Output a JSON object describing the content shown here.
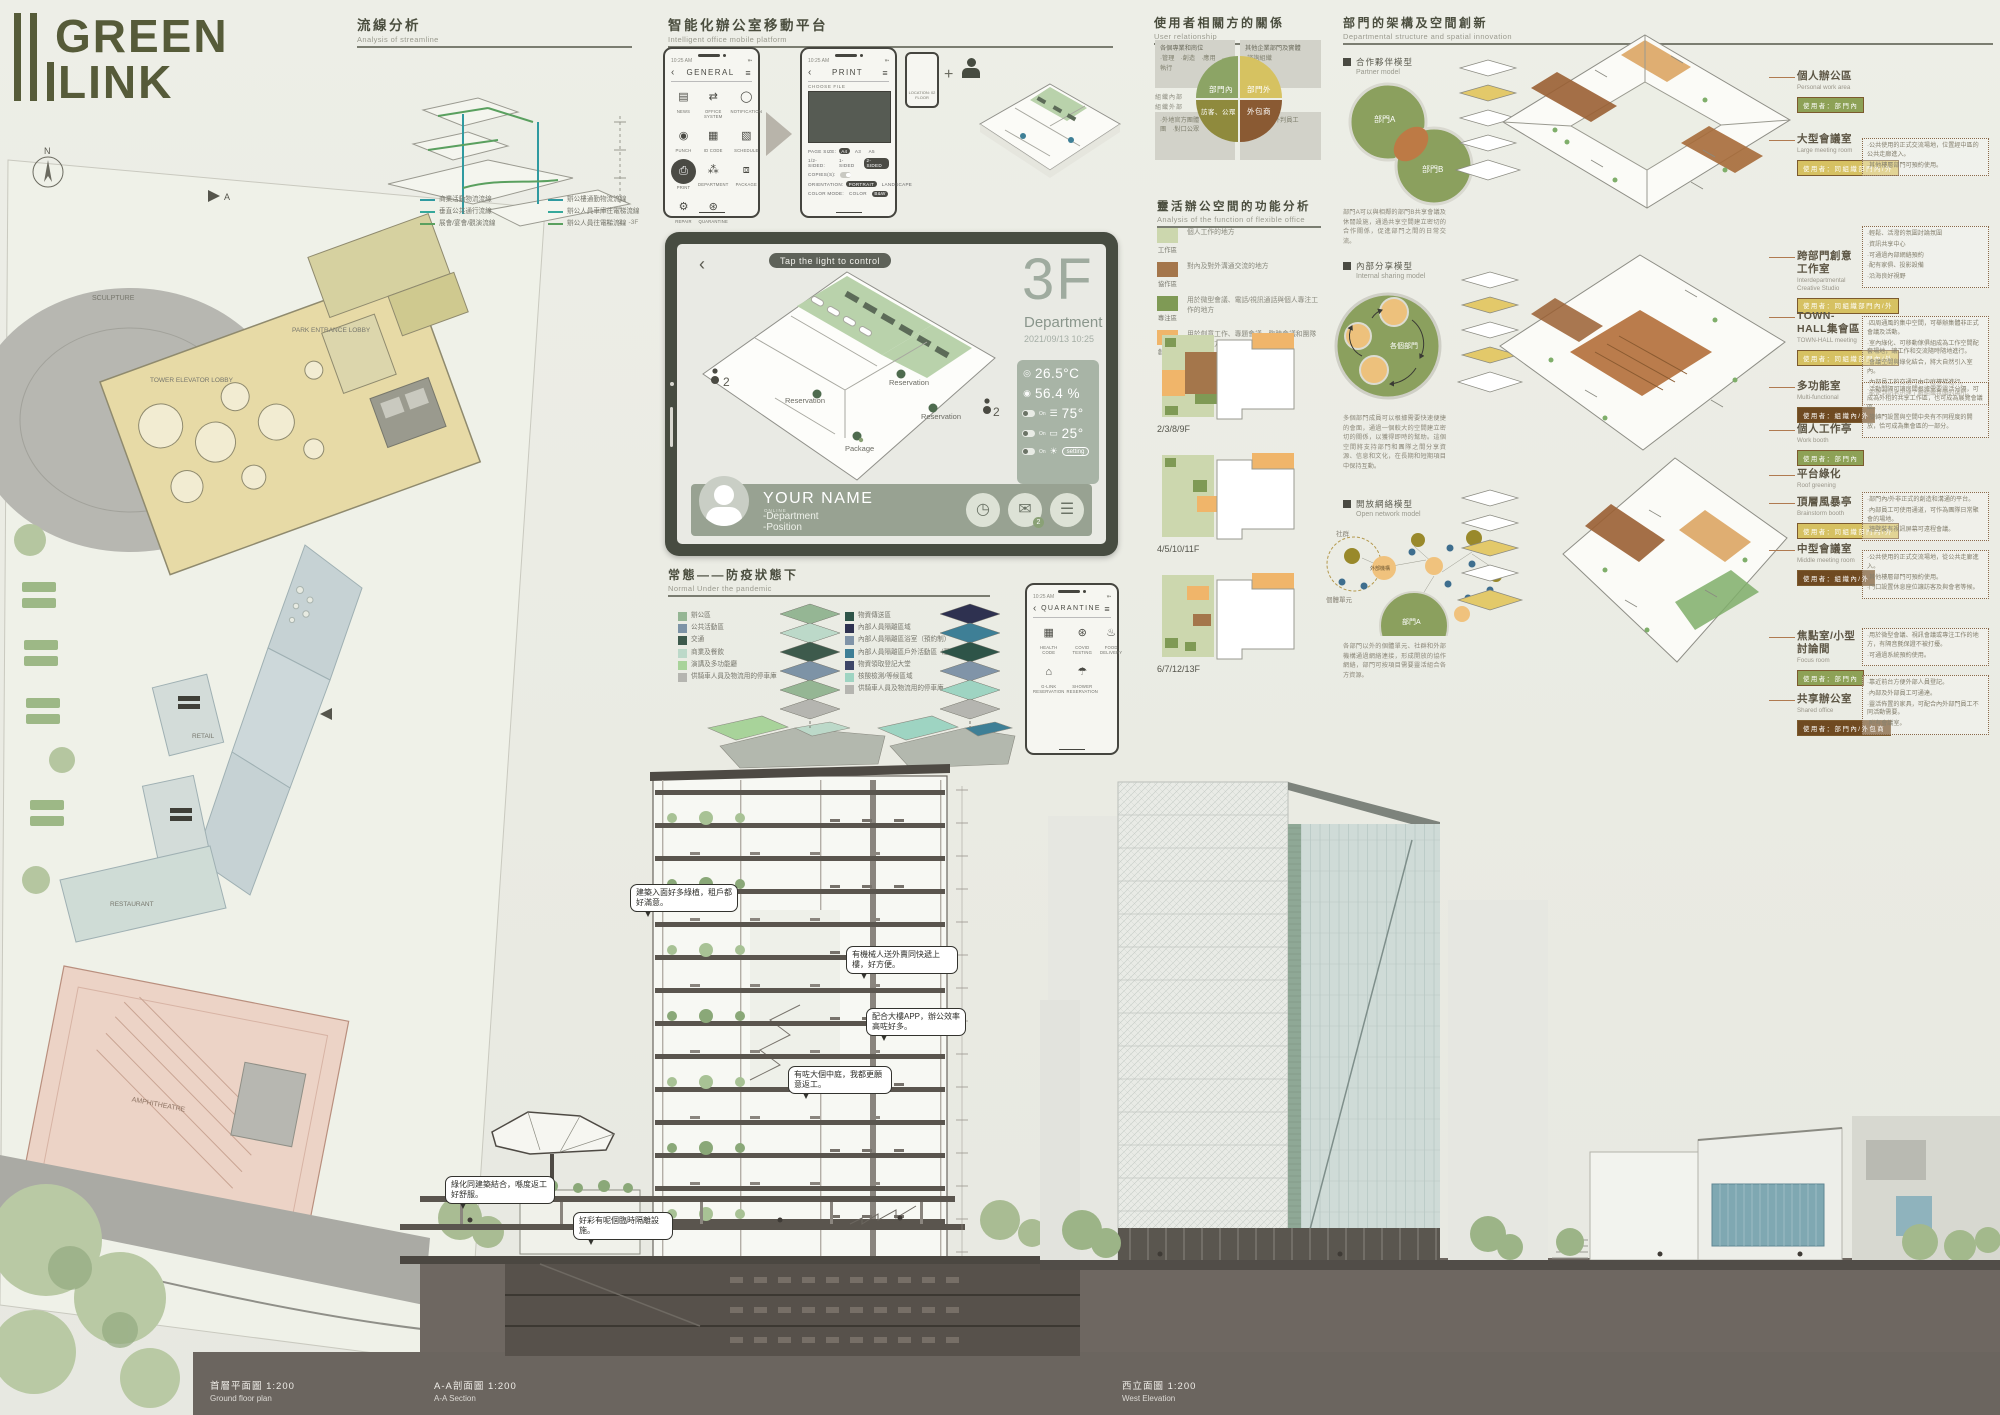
{
  "logo": {
    "line1": "GREEN",
    "line2": "LINK"
  },
  "compass": "N",
  "site_labels": [
    "SCULPTURE",
    "PARK ENTRANCE LOBBY",
    "TOWER ELEVATOR LOBBY",
    "RETAIL",
    "RETAIL",
    "RESTAURANT",
    "AMPHITHEATRE"
  ],
  "streamline": {
    "title_zh": "流線分析",
    "title_en": "Analysis of streamline",
    "levels_note": "-1、-2、-3F",
    "legend_a": [
      {
        "color": "#2f9aa0",
        "label": "商業活動物流流線"
      },
      {
        "color": "#35a89b",
        "label": "垂直公共通行流線"
      },
      {
        "color": "#5aa05f",
        "label": "展會/宴會/觀演流線"
      }
    ],
    "legend_b": [
      {
        "color": "#2f9aa0",
        "label": "辦公樓通勤物流流線"
      },
      {
        "color": "#35a89b",
        "label": "辦公人員車庫往電梯流線"
      },
      {
        "color": "#5aa05f",
        "label": "辦公人員往電梯流線"
      }
    ]
  },
  "platform": {
    "title_zh": "智能化辦公室移動平台",
    "title_en": "Intelligent office mobile platform",
    "general": {
      "time": "10:25 AM",
      "back": "‹",
      "title": "GENERAL",
      "menu": "≡",
      "apps": [
        {
          "icon": "▤",
          "label": "NEWS"
        },
        {
          "icon": "⇄",
          "label": "OFFICE SYSTEM"
        },
        {
          "icon": "◯",
          "label": "NOTIFICATION"
        },
        {
          "icon": "◉",
          "label": "PUNCH"
        },
        {
          "icon": "▦",
          "label": "ID CODE"
        },
        {
          "icon": "▧",
          "label": "SCHEDULE"
        },
        {
          "icon": "⎙",
          "label": "PRINT",
          "active": true
        },
        {
          "icon": "⁂",
          "label": "DEPARTMENT"
        },
        {
          "icon": "⧈",
          "label": "PACKAGE"
        },
        {
          "icon": "⚙",
          "label": "REPAIR"
        },
        {
          "icon": "⊛",
          "label": "QUARANTINE"
        }
      ]
    },
    "print": {
      "time": "10:25 AM",
      "back": "‹",
      "title": "PRINT",
      "menu": "≡",
      "choose_label": "CHOOSE FILE",
      "rows": [
        {
          "label": "PAGE SIZE:",
          "o1": "A4",
          "o2": "A3",
          "o3": "A5"
        },
        {
          "label": "1/2-SIDED:",
          "o1": "1-SIDED",
          "o2": "2-SIDED"
        },
        {
          "label": "COPIES(S):"
        },
        {
          "label": "ORIENTATION:",
          "o1": "PORTRAIT",
          "o2": "LANDSCAPE"
        },
        {
          "label": "COLOR MODE:",
          "o1": "COLOR",
          "o2": "B&W"
        }
      ]
    },
    "mini_phone": {
      "plus": "+",
      "location": "LOCATION:  02 FLOOR"
    }
  },
  "tablet": {
    "back": "‹",
    "pill": "Tap the light to control",
    "floor": "3F",
    "dept": "Department",
    "datetime": "2021/09/13 10:25",
    "temp": "26.5°C",
    "humidity": "56.4 %",
    "blinds": "75°",
    "heater": "25°",
    "toggle_label": "On",
    "setting_label": "setting",
    "plan_labels": [
      "Reservation",
      "Reservation",
      "Reservation",
      "Package"
    ],
    "occupancy": "2",
    "user": {
      "name": "YOUR NAME",
      "status": "ONLINE",
      "line1": "-Department",
      "line2": "-Position"
    }
  },
  "pandemic": {
    "title_zh": "常態——防疫狀態下",
    "title_en": "Normal Under the pandemic",
    "legend_normal": [
      {
        "c": "#95b694",
        "t": "辦公區"
      },
      {
        "c": "#7d93a6",
        "t": "公共活動區"
      },
      {
        "c": "#3d5a4c",
        "t": "交通"
      },
      {
        "c": "#bcd9c9",
        "t": "商業及餐飲"
      },
      {
        "c": "#a8d39a",
        "t": "演講及多功能廳"
      },
      {
        "c": "#b5b5b0",
        "t": "供騎車人員及物流用的停車庫"
      }
    ],
    "legend_pandemic": [
      {
        "c": "#2e5448",
        "t": "物資傳送區"
      },
      {
        "c": "#2e3150",
        "t": "內部人員隔離區域"
      },
      {
        "c": "#8094a8",
        "t": "內部人員隔離區浴室（預約制）"
      },
      {
        "c": "#3e7f96",
        "t": "內部人員隔離區戶外活動區（預約制）"
      },
      {
        "c": "#3d4668",
        "t": "物資領取登記大堂"
      },
      {
        "c": "#9ed4c2",
        "t": "核酸檢測/等候區域"
      },
      {
        "c": "#b5b5b0",
        "t": "供騎車人員及物流用的停車庫"
      }
    ]
  },
  "quarantine": {
    "time": "10:25 AM",
    "back": "‹",
    "title": "QUARANTINE",
    "menu": "≡",
    "apps": [
      {
        "icon": "▦",
        "label": "HEALTH CODE"
      },
      {
        "icon": "⊛",
        "label": "COVID TESTING"
      },
      {
        "icon": "♨",
        "label": "FOOD DELIVERY"
      },
      {
        "icon": "⌂",
        "label": "G-LINK RESERVATION"
      },
      {
        "icon": "☂",
        "label": "SHOWER RESERVATION"
      }
    ]
  },
  "user_relation": {
    "title_zh": "使用者相關方的關係",
    "title_en": "User relationship",
    "inner_label": "組織內部",
    "outer_label": "組織外部",
    "quadrants": [
      {
        "t": "部門內",
        "c": "#8ca465"
      },
      {
        "t": "部門外",
        "c": "#d6c261"
      },
      {
        "t": "訪客、公眾",
        "c": "#8f8a3d"
      },
      {
        "t": "外包商",
        "c": "#8a5a33"
      }
    ],
    "box_tl_head": "各個專業和崗位",
    "box_tl_lines": "·管理　·創造　·應用　·執行",
    "box_tr_head": "其他企業部門及實體",
    "box_tr_lines": "·諮詢組織",
    "box_bl_lines": "·外地官方團體　·民間社團　·對口公眾",
    "box_br_lines": "·供應商　·外判員工"
  },
  "flexible": {
    "title_zh": "靈活辦公空間的功能分析",
    "title_en": "Analysis of the function of flexible office",
    "legend": [
      {
        "c": "#ccd7ae",
        "name": "工作區",
        "desc": "個人工作的地方"
      },
      {
        "c": "#a4764b",
        "name": "協作區",
        "desc": "對內及對外溝通交流的地方"
      },
      {
        "c": "#7f9a55",
        "name": "專注區",
        "desc": "用於微型會議、電話/視訊通話與個人專注工作的地方"
      },
      {
        "c": "#f0b56a",
        "name": "創意區",
        "desc": "用於創意工作、專題會議、臨時會議和團隊項目的地方"
      }
    ],
    "floors": [
      "2/3/8/9F",
      "4/5/10/11F",
      "6/7/12/13F"
    ]
  },
  "department": {
    "title_zh": "部門的架構及空間創新",
    "title_en": "Departmental structure and spatial innovation",
    "models": [
      {
        "zh": "合作夥伴模型",
        "en": "Partner model",
        "desc": "部門A可以與相鄰的部門B共享會議及休閒設施，通過共享空間建立密切的合作關係，促進部門之間的日常交流。"
      },
      {
        "zh": "內部分享模型",
        "en": "Internal sharing model",
        "desc": "多個部門成員可以根據需要快速便捷的會面，通過一個較大的空間建立密切的關係，以獲得即時的幫助。這個空間將支持部門和團隊之間分享資源、信息和文化，在長期和短期項目中保持互動。"
      },
      {
        "zh": "開放網絡模型",
        "en": "Open network model",
        "desc": "各部門以外的個體單元、社群和外部機構通過網絡連接，形成開放的協作網絡，部門可按項目需要靈活組合各方資源。"
      }
    ],
    "venn_a": "部門A",
    "venn_b": "部門B",
    "sharing_center": "各個部門",
    "net_community": "社群",
    "net_external": "外部機構",
    "net_unit": "個體單元",
    "net_dept": "部門A"
  },
  "rooms": [
    {
      "zh": "個人辦公區",
      "en": "Personal work area",
      "chip": "使用者：部門內",
      "chip_c": "#8da156",
      "notes": []
    },
    {
      "zh": "大型會議室",
      "en": "Large meeting room",
      "chip": "使用者：同組織部門內/外",
      "chip_c": "#d6c162",
      "notes": [
        "·公共使用的正式交流場地，位置經中區的公共走廊進入。",
        "·其他樓層部門可預約使用。"
      ]
    },
    {
      "zh": "跨部門創意工作室",
      "en": "Interdepartmental Creative Studio",
      "chip": "使用者：同組織部門內/外",
      "chip_c": "#d6c162",
      "notes": [
        "·輕鬆、活潑的氛圍討論氛圍",
        "·資訊共享中心",
        "·可通過內部網絡預約",
        "·配有家俱、投影設備",
        "·沿海良好視野"
      ]
    },
    {
      "zh": "TOWN-HALL集會區",
      "en": "TOWN-HALL meeting",
      "chip": "使用者：同組織部門內/外",
      "chip_c": "#d6c162",
      "notes": [
        "·四周通風的集中空間，可舉辦集體非正式會議及活動。",
        "·室內綠化、可移動傢俱組成為工作空間配套場地，讓工作和交流隨時隨地進行。",
        "·會議空間與綠化結合，將大自然引入室內。",
        "·內部員工的交通可由中庭樓梯進行。",
        "·能使到訪者迅速了解組織氛圍的場所。"
      ]
    },
    {
      "zh": "多功能室",
      "en": "Multi-functional",
      "chip": "使用者：組織內/外",
      "chip_c": "#6f4a21",
      "notes": [
        "·活動間隔可讓房間根據需要靈活分隔，可成為外租的共享工作區，也可成為展覽會議區。",
        "·旋轉門設置與空間中央有不同程度的開放，恰可成為集會區的一部分。"
      ]
    },
    {
      "zh": "個人工作亭",
      "en": "Work booth",
      "chip": "使用者：部門內",
      "chip_c": "#8da156",
      "notes": []
    },
    {
      "zh": "平台綠化",
      "en": "Roof greening",
      "chip": "",
      "chip_c": "",
      "notes": []
    },
    {
      "zh": "頂層風暴亭",
      "en": "Brainstorm booth",
      "chip": "使用者：同組織部門內/外",
      "chip_c": "#d6c162",
      "notes": [
        "·部門內/外非正式的創造和溝通的平台。",
        "·內部員工可使用通道，可作為團隊日常聚會的場地。",
        "·牆壁裝有視訊屏幕可遠程會議。"
      ]
    },
    {
      "zh": "中型會議室",
      "en": "Middle meeting room",
      "chip": "使用者：組織內/外",
      "chip_c": "#6f4a21",
      "notes": [
        "·公共使用的正式交流場地，從公共走廊進入。",
        "·其他樓層部門可預約使用。",
        "·門口設置休息座位讓訪客及與會者等候。"
      ]
    },
    {
      "zh": "焦點室/小型討論間",
      "en": "Focus room",
      "chip": "使用者：部門內",
      "chip_c": "#8da156",
      "notes": [
        "·用於微型會議、視訊會議或專注工作的地方，有隔音氈保證不被打擾。",
        "·可通過系統預約使用。"
      ]
    },
    {
      "zh": "共享辦公室",
      "en": "Shared office",
      "chip": "使用者：部門內/外包商",
      "chip_c": "#6f4a21",
      "notes": [
        "·靠近前台方便外部人員登記。",
        "·內部及外部員工可通達。",
        "·靈活佈置的家具，可配合內外部門員工不同活動需要。",
        "·附有會議室。"
      ]
    }
  ],
  "bubbles": [
    {
      "t": "建築入面好多綠植，租戶都好滿意。"
    },
    {
      "t": "有機械人送外賣同快遞上樓，好方便。"
    },
    {
      "t": "配合大樓APP，辦公效率高咗好多。"
    },
    {
      "t": "有咗大個中庭，我都更願意返工。"
    },
    {
      "t": "綠化同建築結合，喺度返工好舒服。"
    },
    {
      "t": "好彩有呢個臨時隔離設施。"
    }
  ],
  "captions": [
    {
      "zh": "首層平面圖  1:200",
      "en": "Ground floor plan"
    },
    {
      "zh": "A-A剖面圖  1:200",
      "en": "A-A Section"
    },
    {
      "zh": "西立面圖  1:200",
      "en": "West Elevation"
    }
  ]
}
